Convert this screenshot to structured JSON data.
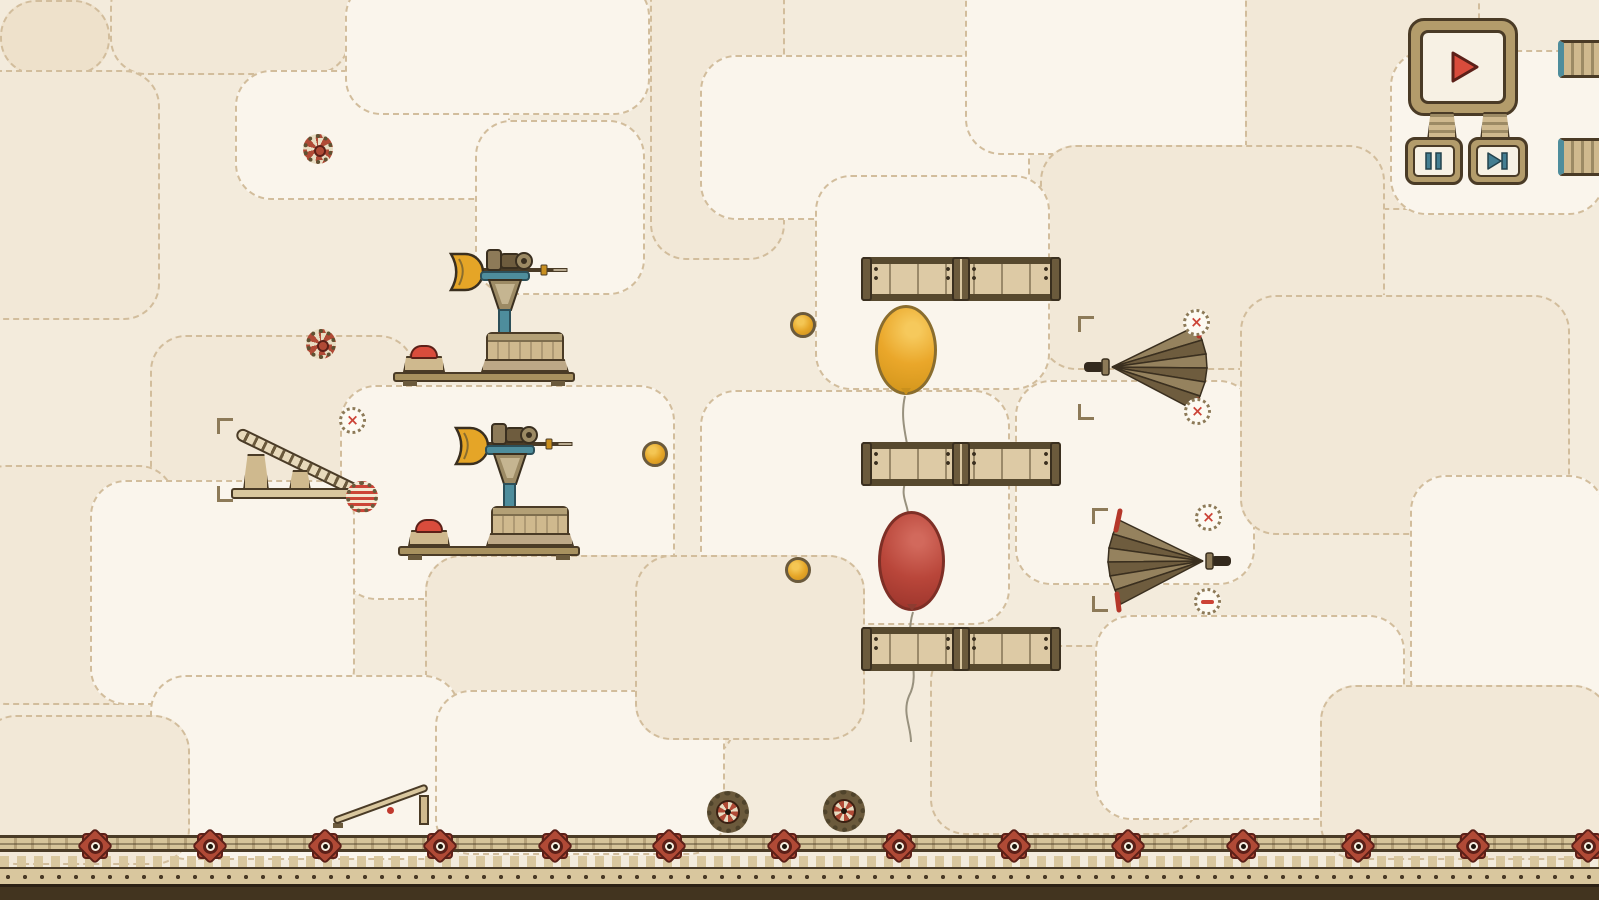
{
  "scene": {
    "type": "steampunk-physics-puzzle-game",
    "visible_text": [],
    "description": "contraption level with dart launchers, balloons, planks, folded umbrellas, conveyor ramp, coins, gears and a geared ground rail"
  },
  "colors": {
    "bg": "#f3ebdc",
    "patch-light": "#faf5ec",
    "patch-mid": "#f2e8d7",
    "patch-dark": "#eee1cb",
    "stitch": "#d2bd9c",
    "outline": "#4a3b26",
    "dark": "#3a2f1f",
    "wood-dark": "#6b5a3c",
    "wood-mid": "#8d7a58",
    "wood-tan": "#cfb98e",
    "wood-pale": "#e2d3ae",
    "panel": "#f7f1e4",
    "frame": "#b39c6b",
    "red": "#d94c3c",
    "gear-red": "#b04a36",
    "deep-red": "#8d3c31",
    "teal": "#4e8d9c",
    "teal-dark": "#2c4f59",
    "gold": "#e5a527",
    "balloon-yellow": "#eaa72a",
    "balloon-red": "#b9463a",
    "string": "#98917e",
    "ground-tan": "#d9c79e",
    "ground-dark": "#42341f"
  },
  "playback": {
    "play_icon": "play-icon",
    "pause_icon": "pause-icon",
    "skip_icon": "skip-next-icon",
    "play_color": "#d94c3c",
    "pause_color": "#447e91",
    "skip_color": "#447e91"
  },
  "markers": {
    "x_glyph": "×"
  },
  "inventory": {
    "dart_launchers": 2,
    "balloons": [
      "yellow",
      "red"
    ],
    "planks": 3,
    "coins": 3,
    "umbrellas": 2,
    "decorative_gears": 2,
    "cart_wheels": 2,
    "conveyor_ramps": 1,
    "small_ramps": 1,
    "x_markers": 4,
    "minus_markers": 1
  },
  "ground": {
    "gear_xs": [
      95,
      210,
      325,
      440,
      555,
      669,
      784,
      899,
      1014,
      1128,
      1243,
      1358,
      1473,
      1588
    ]
  }
}
